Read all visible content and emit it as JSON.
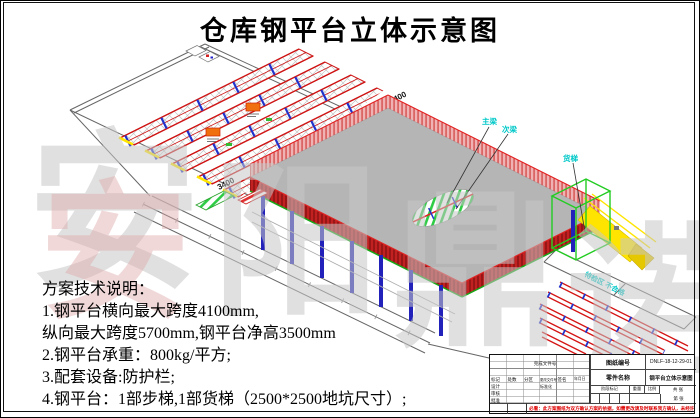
{
  "page": {
    "title": "仓库钢平台立体示意图"
  },
  "notes": {
    "heading": "方案技术说明：",
    "lines": [
      "1.钢平台横向最大跨度4100mm,",
      "纵向最大跨度5700mm,钢平台净高3500mm",
      "2.钢平台承重：800kg/平方;",
      "3.配套设备:防护栏;",
      "4.钢平台：1部步梯,1部货梯（2500*2500地坑尺寸）;"
    ]
  },
  "drawing": {
    "beam_label_main": "主梁",
    "beam_label_secondary": "次梁",
    "cargo_lift_label": "货梯",
    "floor_zone_label": "待检区 不合格",
    "dim_labels": [
      "3400",
      "3400",
      "3400",
      "3400",
      "3400"
    ],
    "colors": {
      "deck": "#b5b5b5",
      "fascia": "#c22121",
      "guardrail": "#efb3b3",
      "rack": "#cf1515",
      "tie": "#2233cc",
      "column": "#2222bb",
      "lift": "#22cc22",
      "stair": "#ffe400",
      "label": "#00c8c8"
    }
  },
  "watermark": {
    "chars": [
      "安",
      "阳",
      "鼎",
      "诺"
    ],
    "pink_char": "安"
  },
  "title_block": {
    "drawing_no_label": "图纸编号",
    "drawing_no": "DNLF-18-12-29-01",
    "part_name_label": "零件名称",
    "part_name": "钢平台立体示意图",
    "labels": {
      "finish_doc": "完成文件号",
      "mark": "标记",
      "count": "处数",
      "zone": "分区",
      "change_doc": "更改文件号",
      "sign": "签名",
      "date": "年月日",
      "design": "设计",
      "review": "审核",
      "approve": "批准",
      "standard": "标准化",
      "stage": "阶段标记",
      "weight": "重量",
      "scale": "比例",
      "total_sheets": "共 张",
      "sheet_no": "第 张"
    },
    "warning": "必看：此方案图纸为双方确认方案的依据，如需更改请及时联系我方确认，未经许可不得复制、外传！"
  }
}
